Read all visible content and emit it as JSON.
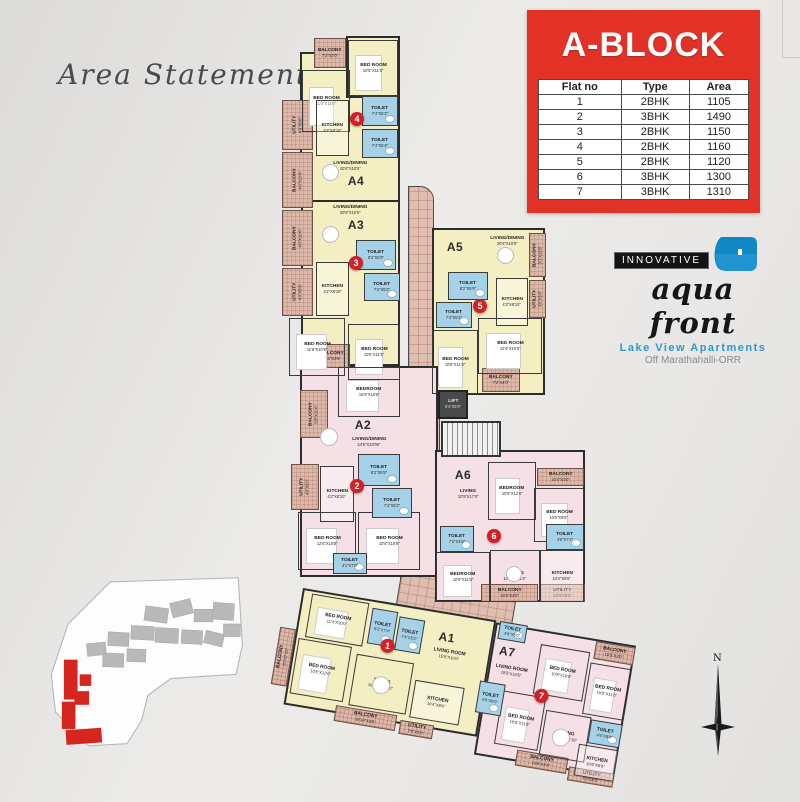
{
  "colors": {
    "accent_red": "#e23227",
    "badge_red": "#d41f27",
    "unit_yellow": "#f3efc3",
    "unit_pink": "#f5e0e5",
    "toilet_blue": "#a6d2e9",
    "balcony_tan": "#dcb9ab",
    "wall": "#2c2c2c",
    "logo_blue": "#1287c6"
  },
  "area_statement": {
    "title": "Area Statement"
  },
  "block_panel": {
    "title": "A-BLOCK",
    "table": {
      "headers": [
        "Flat no",
        "Type",
        "Area"
      ],
      "rows": [
        [
          "1",
          "2BHK",
          "1105"
        ],
        [
          "2",
          "3BHK",
          "1490"
        ],
        [
          "3",
          "2BHK",
          "1150"
        ],
        [
          "4",
          "2BHK",
          "1160"
        ],
        [
          "5",
          "2BHK",
          "1120"
        ],
        [
          "6",
          "3BHK",
          "1300"
        ],
        [
          "7",
          "3BHK",
          "1310"
        ]
      ]
    }
  },
  "logo": {
    "brand_top": "INNOVATIVE",
    "brand_script": "aqua front",
    "tagline": "Lake View Apartments",
    "location": "Off Marathahalli-ORR"
  },
  "compass": {
    "label": "N"
  },
  "plan": {
    "upper": [
      {
        "t": "co",
        "x": 408,
        "y": 186,
        "w": 26,
        "h": 214,
        "r2": true,
        "dn": "corridor"
      },
      {
        "t": "co",
        "x": 400,
        "y": 398,
        "w": 40,
        "h": 190,
        "dn": "corridor"
      },
      {
        "t": "co",
        "x": 404,
        "y": 556,
        "w": 118,
        "h": 74,
        "rot": 9.5,
        "dn": "corridor-link"
      },
      {
        "t": "uy",
        "x": 300,
        "y": 52,
        "w": 100,
        "h": 150,
        "dn": "unit-a4"
      },
      {
        "t": "uy",
        "x": 346,
        "y": 36,
        "w": 54,
        "h": 62,
        "dn": "unit-a4"
      },
      {
        "t": "uy",
        "x": 301,
        "y": 200,
        "w": 99,
        "h": 166,
        "dn": "unit-a3"
      },
      {
        "t": "uy",
        "x": 432,
        "y": 228,
        "w": 113,
        "h": 167,
        "dn": "unit-a5"
      },
      {
        "t": "up",
        "x": 300,
        "y": 366,
        "w": 138,
        "h": 211,
        "dn": "unit-a2"
      },
      {
        "t": "up",
        "x": 435,
        "y": 450,
        "w": 150,
        "h": 152,
        "dn": "unit-a6"
      },
      {
        "t": "ha",
        "x": 314,
        "y": 38,
        "w": 32,
        "h": 30,
        "n": "BALCONY",
        "d": "7'2\"X3'0\""
      },
      {
        "t": "ha",
        "x": 282,
        "y": 100,
        "w": 31,
        "h": 50,
        "n": "UTILITY",
        "d": "4'0\"X5'6\"",
        "vert": true
      },
      {
        "t": "ha",
        "x": 282,
        "y": 152,
        "w": 31,
        "h": 56,
        "n": "BALCONY",
        "d": "4'0\"X10'6\"",
        "vert": true
      },
      {
        "t": "ha",
        "x": 282,
        "y": 210,
        "w": 31,
        "h": 56,
        "n": "BALCONY",
        "d": "4'0\"X10'6\"",
        "vert": true
      },
      {
        "t": "ha",
        "x": 282,
        "y": 268,
        "w": 31,
        "h": 48,
        "n": "UTILITY",
        "d": "4'0\"X5'6\"",
        "vert": true
      },
      {
        "t": "ha",
        "x": 314,
        "y": 344,
        "w": 36,
        "h": 24,
        "n": "BALCONY",
        "d": "9'10\"X3'6\""
      },
      {
        "t": "ha",
        "x": 529,
        "y": 233,
        "w": 17,
        "h": 44,
        "n": "BALCONY",
        "d": "3'0\"X10'6\"",
        "vert": true
      },
      {
        "t": "ha",
        "x": 529,
        "y": 280,
        "w": 17,
        "h": 38,
        "n": "UTILITY",
        "d": "3'0\"X5'6\"",
        "vert": true
      },
      {
        "t": "ha",
        "x": 482,
        "y": 368,
        "w": 38,
        "h": 24,
        "n": "BALCONY",
        "d": "7'2\"X4'0\""
      },
      {
        "t": "ha",
        "x": 300,
        "y": 390,
        "w": 28,
        "h": 48,
        "n": "BALCONY",
        "d": "5'8\"X10'6\"",
        "vert": true
      },
      {
        "t": "ha",
        "x": 291,
        "y": 464,
        "w": 28,
        "h": 46,
        "n": "UTILITY",
        "d": "4'0\"X5'0\"",
        "vert": true
      },
      {
        "t": "ha",
        "x": 537,
        "y": 468,
        "w": 47,
        "h": 18,
        "n": "BALCONY",
        "d": "10'4\"X3'0\""
      },
      {
        "t": "ha",
        "x": 481,
        "y": 584,
        "w": 57,
        "h": 18,
        "n": "BALCONY",
        "d": "10'3\"X4'0\""
      },
      {
        "t": "ha",
        "x": 540,
        "y": 584,
        "w": 45,
        "h": 18,
        "n": "UTILITY",
        "d": "10'4\"X4'0\""
      },
      {
        "t": "bed",
        "x": 348,
        "y": 40,
        "w": 50,
        "h": 56,
        "n": "BED ROOM",
        "d": "10'5\"X11'5\""
      },
      {
        "t": "bed",
        "x": 302,
        "y": 70,
        "w": 48,
        "h": 62,
        "n": "BED ROOM",
        "d": "11'0\"X11'0\""
      },
      {
        "t": "to",
        "x": 362,
        "y": 96,
        "w": 36,
        "h": 30,
        "n": "TOILET",
        "d": "7'4\"X5'2\""
      },
      {
        "t": "to",
        "x": 362,
        "y": 129,
        "w": 36,
        "h": 29,
        "n": "TOILET",
        "d": "7'4\"X5'4\""
      },
      {
        "t": "ki",
        "x": 316,
        "y": 100,
        "w": 33,
        "h": 56,
        "n": "KITCHEN",
        "d": "4'2\"X8'10\""
      },
      {
        "t": "ki",
        "x": 316,
        "y": 262,
        "w": 33,
        "h": 54,
        "n": "KITCHEN",
        "d": "4'2\"X8'10\""
      },
      {
        "t": "to",
        "x": 356,
        "y": 240,
        "w": 40,
        "h": 30,
        "n": "TOILET",
        "d": "8'2\"X5'9\""
      },
      {
        "t": "to",
        "x": 364,
        "y": 273,
        "w": 36,
        "h": 28,
        "n": "TOILET",
        "d": "7'4\"X5'2\""
      },
      {
        "t": "bed",
        "x": 289,
        "y": 318,
        "w": 56,
        "h": 58,
        "n": "BED ROOM",
        "d": "11'6\"X10'9\""
      },
      {
        "t": "bed",
        "x": 348,
        "y": 324,
        "w": 52,
        "h": 56,
        "n": "BED ROOM",
        "d": "10'5\"X11'5\""
      },
      {
        "t": "to",
        "x": 448,
        "y": 272,
        "w": 40,
        "h": 28,
        "n": "TOILET",
        "d": "8'2\"X5'9\""
      },
      {
        "t": "to",
        "x": 436,
        "y": 302,
        "w": 36,
        "h": 26,
        "n": "TOILET",
        "d": "7'4\"X5'2\""
      },
      {
        "t": "ki",
        "x": 496,
        "y": 278,
        "w": 32,
        "h": 48,
        "n": "KITCHEN",
        "d": "4'2\"X8'10\""
      },
      {
        "t": "bed",
        "x": 478,
        "y": 318,
        "w": 64,
        "h": 56,
        "n": "BED ROOM",
        "d": "12'6\"X10'6\""
      },
      {
        "t": "bed",
        "x": 432,
        "y": 330,
        "w": 46,
        "h": 64,
        "n": "BED ROOM",
        "d": "10'8\"X11'5\""
      },
      {
        "t": "bed",
        "x": 338,
        "y": 367,
        "w": 62,
        "h": 50,
        "n": "BEDROOM",
        "d": "15'5\"X10'6\""
      },
      {
        "t": "ki",
        "x": 320,
        "y": 466,
        "w": 34,
        "h": 56,
        "n": "KITCHEN",
        "d": "4'2\"X8'10\""
      },
      {
        "t": "to",
        "x": 358,
        "y": 454,
        "w": 42,
        "h": 32,
        "n": "TOILET",
        "d": "8'2\"X5'9\""
      },
      {
        "t": "to",
        "x": 372,
        "y": 488,
        "w": 40,
        "h": 30,
        "n": "TOILET",
        "d": "7'4\"X5'2\""
      },
      {
        "t": "bed",
        "x": 298,
        "y": 512,
        "w": 58,
        "h": 58,
        "n": "BED ROOM",
        "d": "12'6\"X10'8\""
      },
      {
        "t": "bed",
        "x": 358,
        "y": 512,
        "w": 62,
        "h": 58,
        "n": "BED ROOM",
        "d": "10'8\"X10'9\""
      },
      {
        "t": "to",
        "x": 333,
        "y": 553,
        "w": 34,
        "h": 21,
        "n": "TOILET",
        "d": "4'1\"X7'9\""
      },
      {
        "t": "bed",
        "x": 488,
        "y": 462,
        "w": 48,
        "h": 58,
        "n": "BEDROOM",
        "d": "10'5\"X12'0\""
      },
      {
        "t": "bed",
        "x": 534,
        "y": 488,
        "w": 50,
        "h": 54,
        "n": "BED ROOM",
        "d": "10'5\"X9'6\""
      },
      {
        "t": "to",
        "x": 440,
        "y": 526,
        "w": 34,
        "h": 26,
        "n": "TOILET",
        "d": "7'2\"X4'6\""
      },
      {
        "t": "to",
        "x": 546,
        "y": 524,
        "w": 38,
        "h": 26,
        "n": "TOILET",
        "d": "4'6\"X7'4\""
      },
      {
        "t": "bed",
        "x": 436,
        "y": 552,
        "w": 54,
        "h": 50,
        "n": "BEDROOM",
        "d": "10'5\"X11'6\""
      },
      {
        "t": "rm",
        "x": 490,
        "y": 550,
        "w": 50,
        "h": 52,
        "n": "DINING",
        "d": "10'10\"X11'4\""
      },
      {
        "t": "ki",
        "x": 540,
        "y": 550,
        "w": 44,
        "h": 52,
        "n": "KITCHEN",
        "d": "10'4\"X8'6\""
      },
      {
        "t": "fl",
        "x": 308,
        "y": 158,
        "w": 84,
        "h": 16,
        "n": "LIVING/DINING",
        "d": "20'6\"X10'6\""
      },
      {
        "t": "fl",
        "x": 308,
        "y": 202,
        "w": 84,
        "h": 16,
        "n": "LIVING/DINING",
        "d": "20'6\"X10'6\""
      },
      {
        "t": "fl",
        "x": 470,
        "y": 233,
        "w": 74,
        "h": 16,
        "n": "LIVING/DINING",
        "d": "20'6\"X10'9\""
      },
      {
        "t": "fl",
        "x": 326,
        "y": 434,
        "w": 86,
        "h": 16,
        "n": "LIVING/DINING",
        "d": "24'5\"X10'06\""
      },
      {
        "t": "fl",
        "x": 442,
        "y": 486,
        "w": 52,
        "h": 16,
        "n": "LIVING",
        "d": "10'5\"X17'0\""
      },
      {
        "t": "ul",
        "x": 341,
        "y": 174,
        "w": 30,
        "h": 14,
        "n": "A4"
      },
      {
        "t": "ul",
        "x": 341,
        "y": 218,
        "w": 30,
        "h": 14,
        "n": "A3"
      },
      {
        "t": "ul",
        "x": 440,
        "y": 240,
        "w": 30,
        "h": 14,
        "n": "A5"
      },
      {
        "t": "ul",
        "x": 348,
        "y": 418,
        "w": 30,
        "h": 14,
        "n": "A2"
      },
      {
        "t": "ul",
        "x": 448,
        "y": 468,
        "w": 30,
        "h": 14,
        "n": "A6"
      },
      {
        "t": "li",
        "x": 438,
        "y": 390,
        "w": 30,
        "h": 29,
        "n": "LIFT",
        "d": "5'4\"X5'9\""
      },
      {
        "t": "st",
        "x": 441,
        "y": 421,
        "w": 60,
        "h": 36,
        "dn": "staircase"
      },
      {
        "t": "tb",
        "x": 322,
        "y": 164,
        "w": 17,
        "h": 17
      },
      {
        "t": "tb",
        "x": 322,
        "y": 226,
        "w": 17,
        "h": 17
      },
      {
        "t": "tb",
        "x": 497,
        "y": 247,
        "w": 17,
        "h": 17
      },
      {
        "t": "tb",
        "x": 320,
        "y": 428,
        "w": 18,
        "h": 18
      },
      {
        "t": "tb",
        "x": 506,
        "y": 566,
        "w": 16,
        "h": 16
      },
      {
        "t": "ba",
        "x": 350,
        "y": 112,
        "n": "4"
      },
      {
        "t": "ba",
        "x": 349,
        "y": 256,
        "n": "3"
      },
      {
        "t": "ba",
        "x": 473,
        "y": 299,
        "n": "5"
      },
      {
        "t": "ba",
        "x": 350,
        "y": 479,
        "n": "2"
      },
      {
        "t": "ba",
        "x": 487,
        "y": 529,
        "n": "6"
      }
    ],
    "lower": [
      {
        "t": "uy",
        "x": 0,
        "y": 0,
        "w": 196,
        "h": 118,
        "dn": "unit-a1"
      },
      {
        "t": "up",
        "x": 196,
        "y": 2,
        "w": 142,
        "h": 134,
        "dn": "unit-a7"
      },
      {
        "t": "ha",
        "x": -16,
        "y": 42,
        "w": 16,
        "h": 58,
        "n": "BALCONY",
        "d": "3'0\"X7'10\"",
        "vert": true
      },
      {
        "t": "ha",
        "x": 52,
        "y": 110,
        "w": 62,
        "h": 16,
        "n": "BALCONY",
        "d": "10'10\"X3'5\""
      },
      {
        "t": "ha",
        "x": 118,
        "y": 114,
        "w": 34,
        "h": 14,
        "n": "UTILITY",
        "d": "7'0\"X5'0\""
      },
      {
        "t": "ha",
        "x": 298,
        "y": 4,
        "w": 40,
        "h": 18,
        "n": "BALCONY",
        "d": "10'5\"X3'0\""
      },
      {
        "t": "ha",
        "x": 238,
        "y": 124,
        "w": 52,
        "h": 16,
        "n": "BALCONY",
        "d": "10'5\"X3'6\""
      },
      {
        "t": "ha",
        "x": 292,
        "y": 132,
        "w": 46,
        "h": 14,
        "n": "UTILITY",
        "d": "7'0\"X5'0\""
      },
      {
        "t": "bed",
        "x": 10,
        "y": 4,
        "w": 58,
        "h": 44,
        "n": "BED ROOM",
        "d": "11'4\"X10'0\""
      },
      {
        "t": "to",
        "x": 72,
        "y": 8,
        "w": 26,
        "h": 36,
        "n": "TOILET",
        "d": "5'2\"X7'4\""
      },
      {
        "t": "to",
        "x": 100,
        "y": 12,
        "w": 26,
        "h": 34,
        "n": "TOILET",
        "d": "7'4\"X5'2\""
      },
      {
        "t": "bed",
        "x": 4,
        "y": 50,
        "w": 54,
        "h": 56,
        "n": "BED ROOM",
        "d": "10'5\"X12'0\""
      },
      {
        "t": "rm",
        "x": 64,
        "y": 56,
        "w": 58,
        "h": 52,
        "n": "DINING",
        "d": "10'10\"X12'10\""
      },
      {
        "t": "ki",
        "x": 126,
        "y": 72,
        "w": 50,
        "h": 38,
        "n": "KITCHEN",
        "d": "10'4\"X8'6\""
      },
      {
        "t": "to",
        "x": 200,
        "y": 0,
        "w": 28,
        "h": 18,
        "n": "TOILET",
        "d": "4'6\"X5'0\""
      },
      {
        "t": "bed",
        "x": 244,
        "y": 16,
        "w": 50,
        "h": 50,
        "n": "BED ROOM",
        "d": "10'5\"X10'5\""
      },
      {
        "t": "bed",
        "x": 296,
        "y": 26,
        "w": 42,
        "h": 52,
        "n": "BED ROOM",
        "d": "10'5\"X11'5\""
      },
      {
        "t": "to",
        "x": 190,
        "y": 62,
        "w": 26,
        "h": 32,
        "n": "TOILET",
        "d": "4'6\"X8'0\""
      },
      {
        "t": "bed",
        "x": 214,
        "y": 68,
        "w": 44,
        "h": 54,
        "n": "BED ROOM",
        "d": "10'5\"X11'5\""
      },
      {
        "t": "rm",
        "x": 260,
        "y": 80,
        "w": 46,
        "h": 46,
        "n": "DINING",
        "d": "10'10\"X12'10\""
      },
      {
        "t": "to",
        "x": 306,
        "y": 82,
        "w": 32,
        "h": 24,
        "n": "TOILET",
        "d": "4'6\"X8'0\""
      },
      {
        "t": "ki",
        "x": 298,
        "y": 108,
        "w": 40,
        "h": 32,
        "n": "KITCHEN",
        "d": "10'5\"X8'6\""
      },
      {
        "t": "fl",
        "x": 124,
        "y": 34,
        "w": 62,
        "h": 16,
        "n": "LIVING ROOM",
        "d": "15'5\"X10'0\""
      },
      {
        "t": "fl",
        "x": 188,
        "y": 40,
        "w": 62,
        "h": 16,
        "n": "LIVING ROOM",
        "d": "15'5\"X10'5\""
      },
      {
        "t": "ul",
        "x": 136,
        "y": 18,
        "w": 28,
        "h": 13,
        "n": "A1"
      },
      {
        "t": "ul",
        "x": 198,
        "y": 22,
        "w": 28,
        "h": 13,
        "n": "A7"
      },
      {
        "t": "tb",
        "x": 84,
        "y": 74,
        "w": 18,
        "h": 18
      },
      {
        "t": "tb",
        "x": 270,
        "y": 96,
        "w": 18,
        "h": 18
      },
      {
        "t": "ba",
        "x": 86,
        "y": 36,
        "n": "1"
      },
      {
        "t": "ba",
        "x": 246,
        "y": 60,
        "n": "7"
      }
    ]
  }
}
